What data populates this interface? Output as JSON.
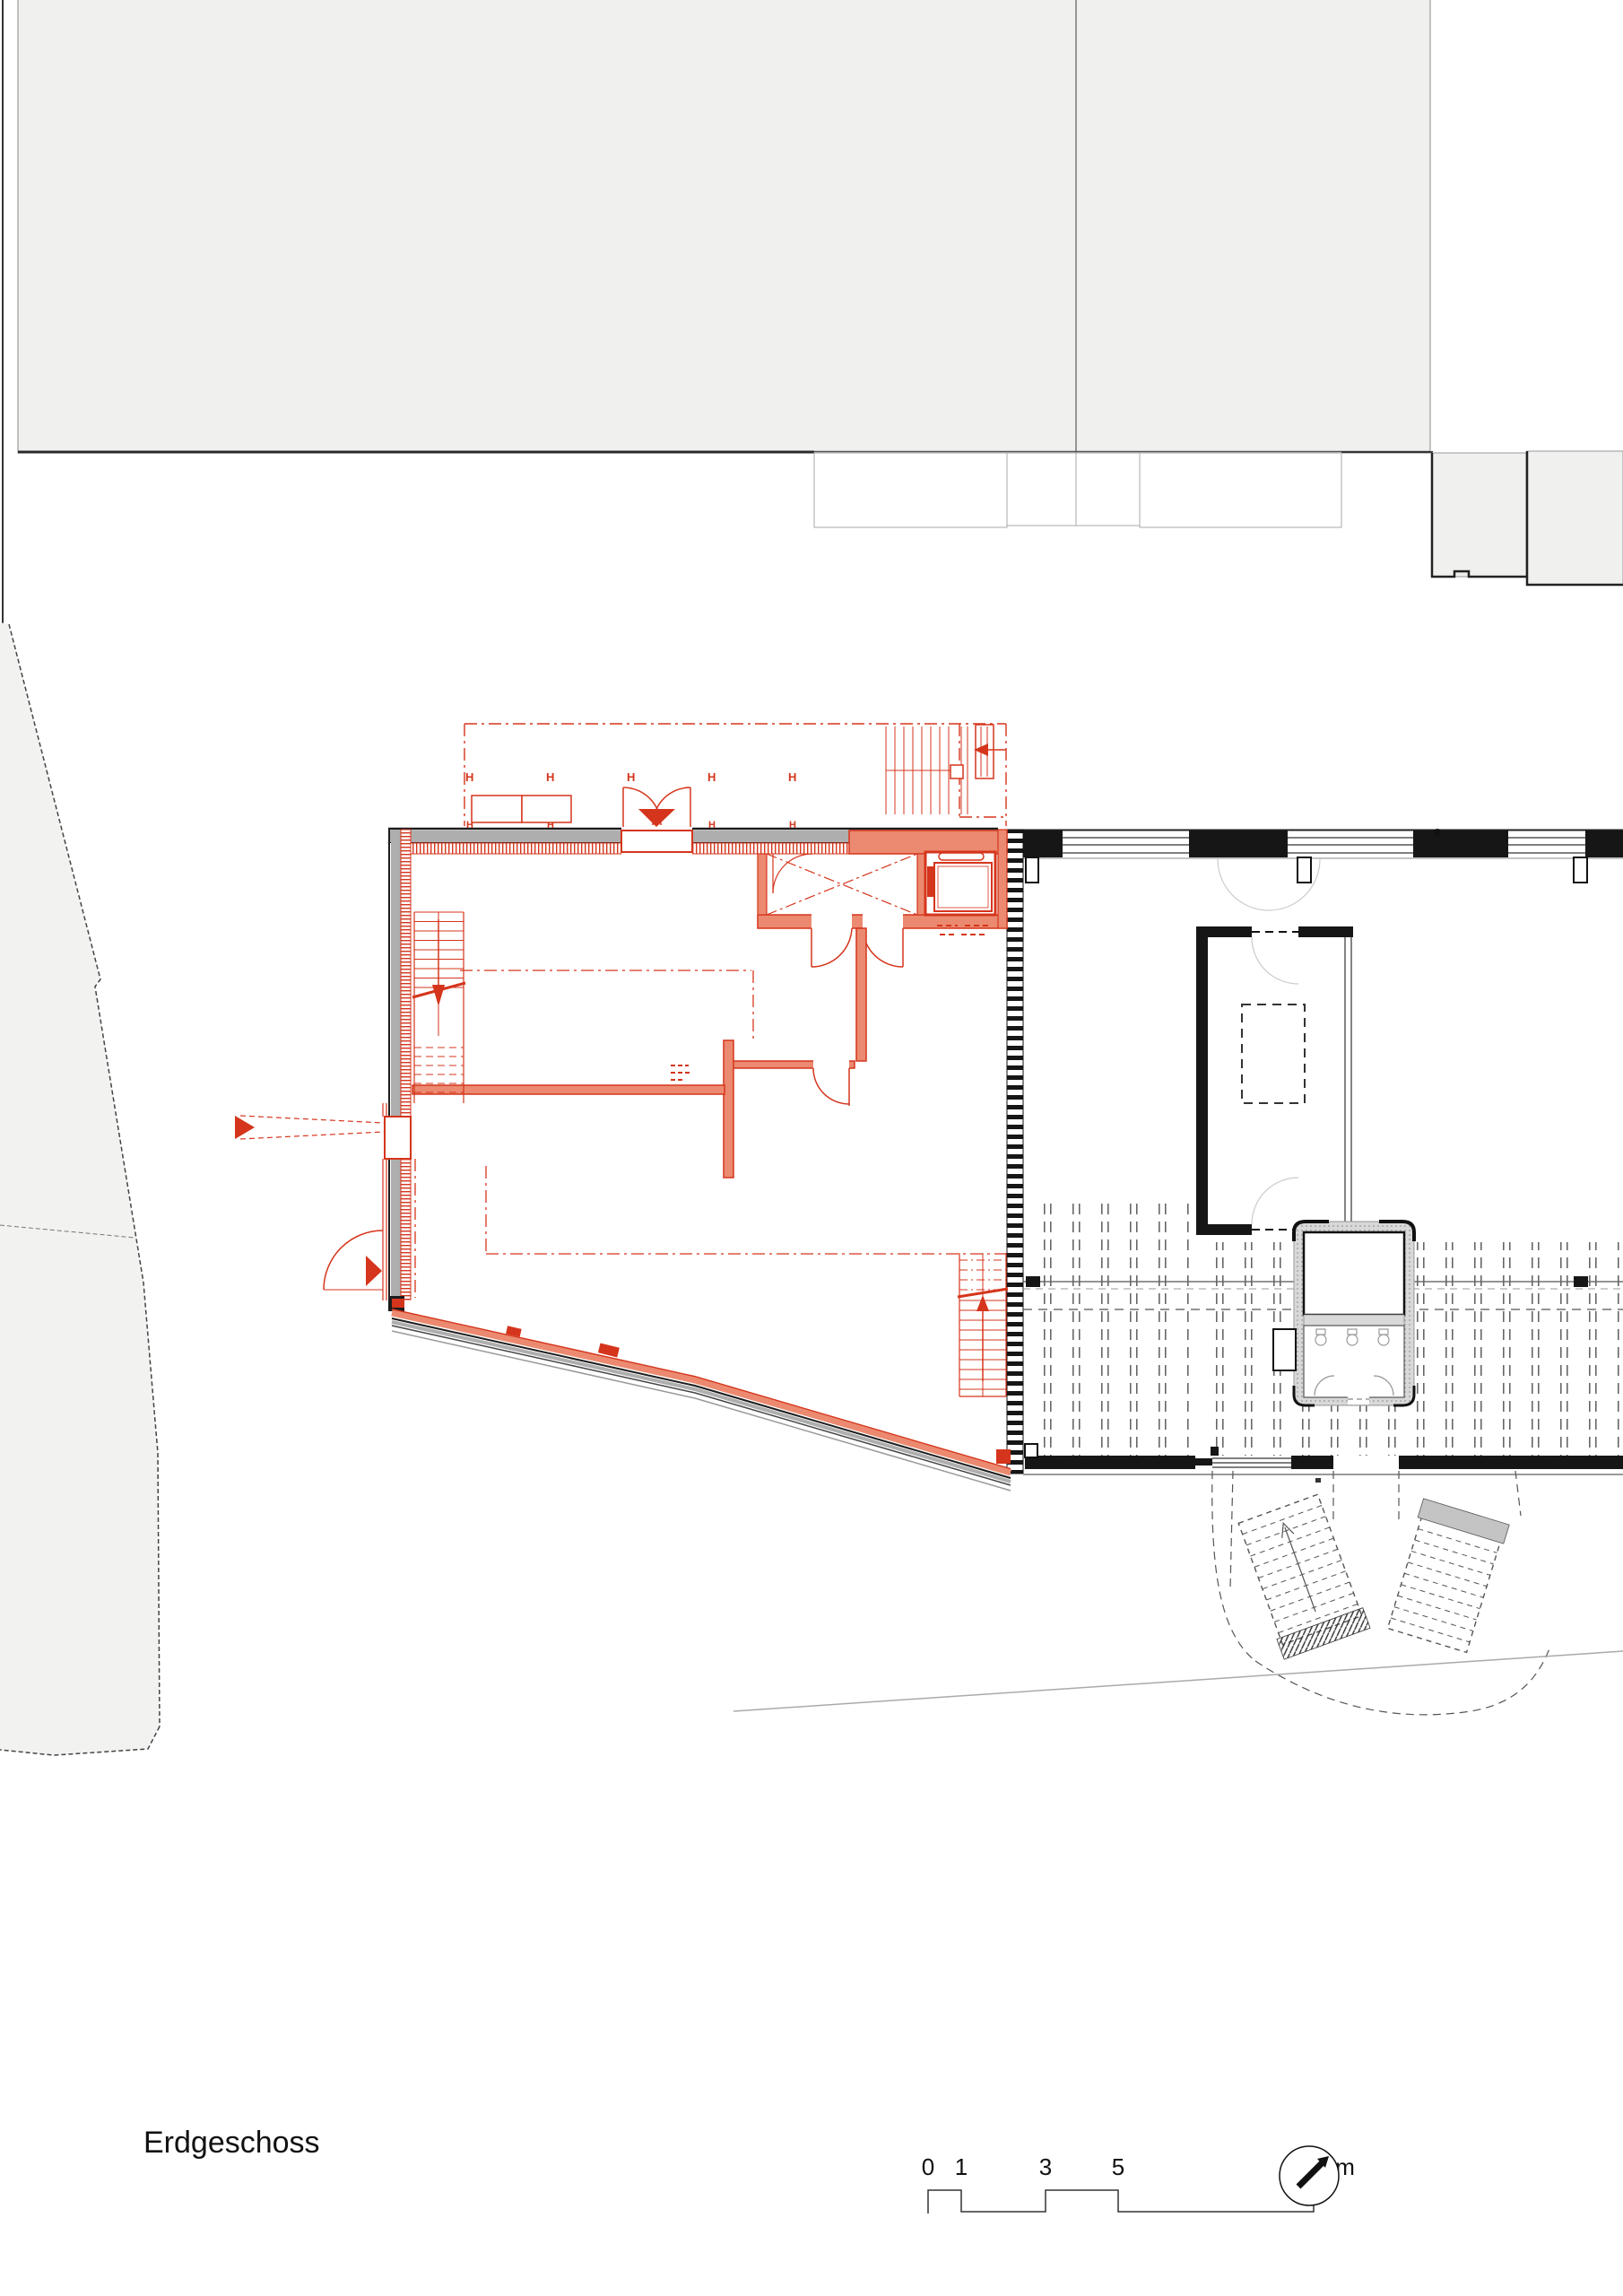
{
  "drawing": {
    "floor_label": "Erdgeschoss",
    "column_marker": "H",
    "scale_bar": {
      "labels": [
        "0",
        "1",
        "3",
        "5",
        "10 m"
      ],
      "values": [
        0,
        1,
        3,
        5,
        10
      ],
      "unit": "m"
    },
    "north_arrow": "north-arrow-compass",
    "colors": {
      "new_construction_red": "#d5351c",
      "red_wall_fill": "#eb8a70",
      "existing_black": "#161616",
      "neighbor_fill": "#f0f0ee",
      "parcel_fill": "#f2f2f1",
      "gray_wall_band": "#aeaeae",
      "faint_line": "#aaaaaa"
    }
  }
}
